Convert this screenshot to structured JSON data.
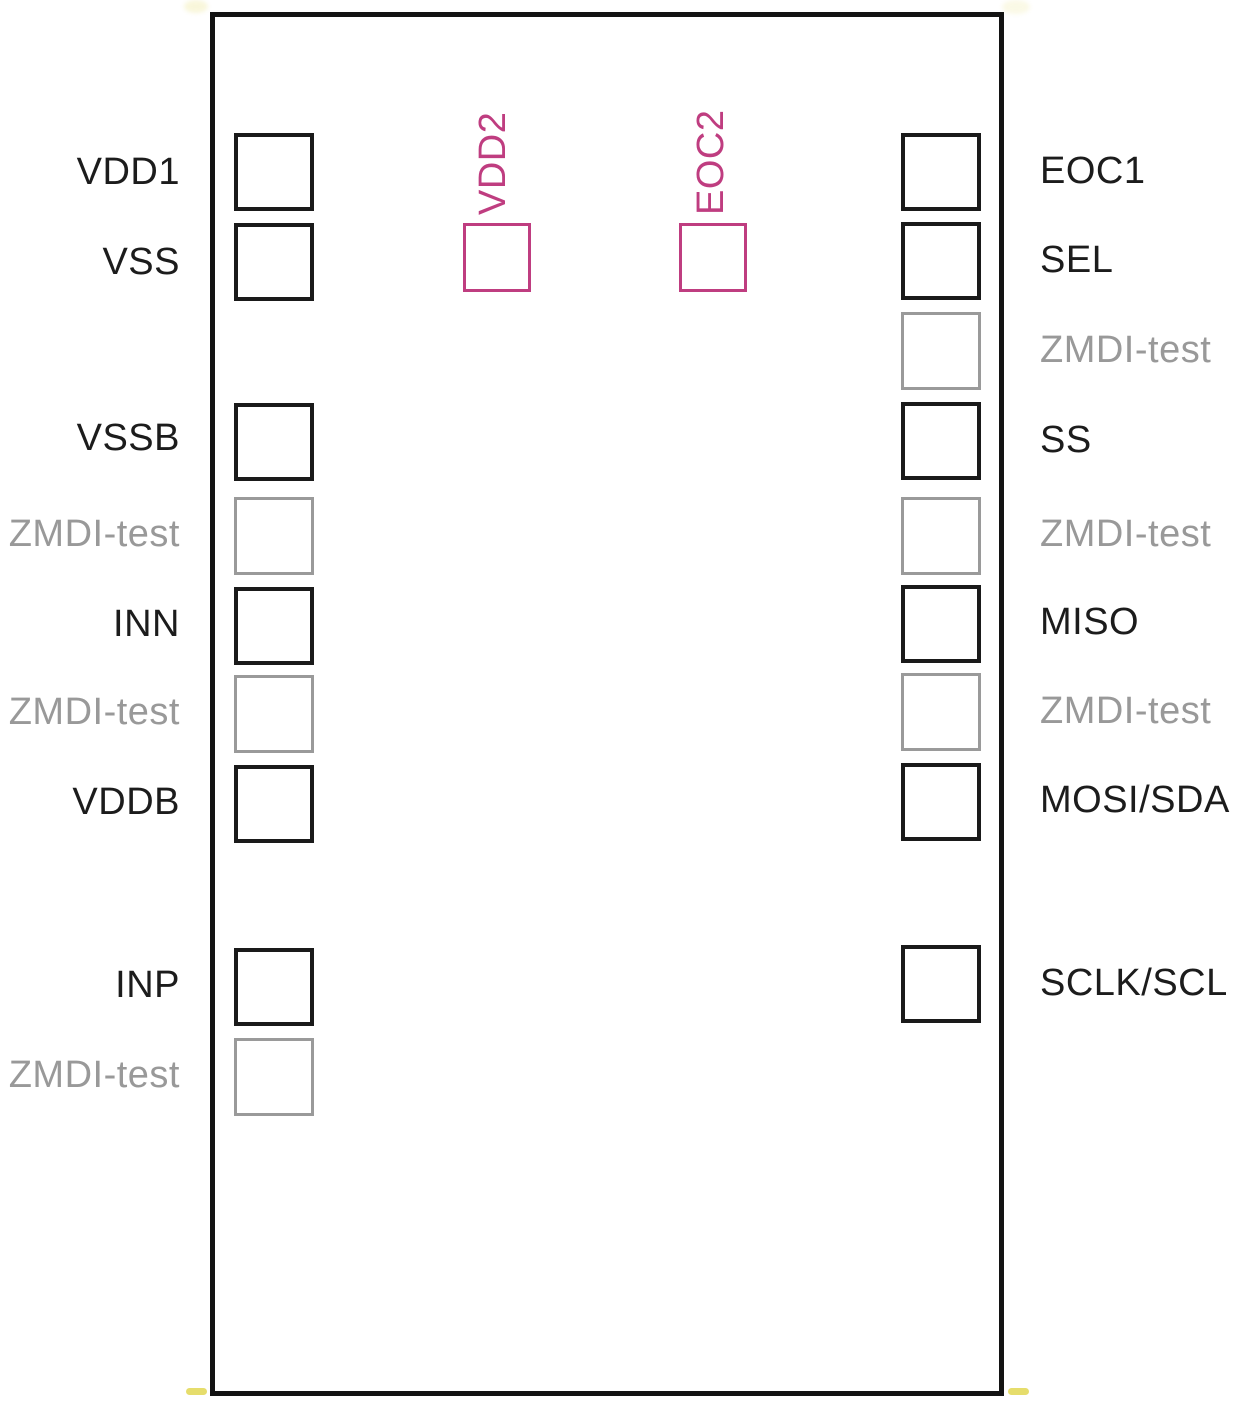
{
  "diagram": {
    "type": "chip-bonding-pad-pinout",
    "background_color": "#ffffff",
    "outline_color": "#131313",
    "pin_colors": {
      "standard": "#1a1a1a",
      "test": "#9a9a9a",
      "top": "#bf3d80"
    },
    "corner_mark_color": "#e3d95c",
    "left_pins": [
      {
        "label": "VDD1",
        "type": "standard"
      },
      {
        "label": "VSS",
        "type": "standard"
      },
      {
        "label": "VSSB",
        "type": "standard"
      },
      {
        "label": "ZMDI-test",
        "type": "test"
      },
      {
        "label": "INN",
        "type": "standard"
      },
      {
        "label": "ZMDI-test",
        "type": "test"
      },
      {
        "label": "VDDB",
        "type": "standard"
      },
      {
        "label": "INP",
        "type": "standard"
      },
      {
        "label": "ZMDI-test",
        "type": "test"
      }
    ],
    "right_pins": [
      {
        "label": "EOC1",
        "type": "standard"
      },
      {
        "label": "SEL",
        "type": "standard"
      },
      {
        "label": "ZMDI-test",
        "type": "test"
      },
      {
        "label": "SS",
        "type": "standard"
      },
      {
        "label": "ZMDI-test",
        "type": "test"
      },
      {
        "label": "MISO",
        "type": "standard"
      },
      {
        "label": "ZMDI-test",
        "type": "test"
      },
      {
        "label": "MOSI/SDA",
        "type": "standard"
      },
      {
        "label": "SCLK/SCL",
        "type": "standard"
      }
    ],
    "top_pins": [
      {
        "label": "VDD2",
        "type": "top"
      },
      {
        "label": "EOC2",
        "type": "top"
      }
    ]
  }
}
